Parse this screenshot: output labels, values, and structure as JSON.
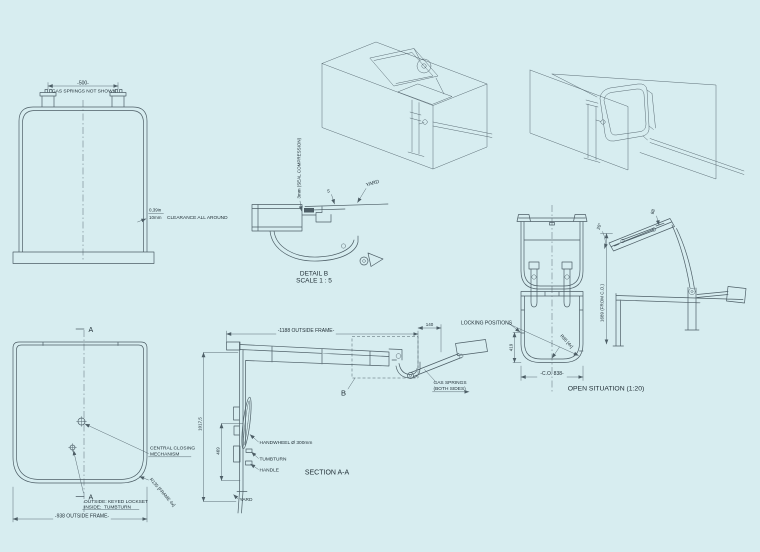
{
  "drawing": {
    "palette": {
      "background": "#d7edf0",
      "line": "#4d5e66",
      "text": "#233138"
    },
    "views": {
      "closed_view": {
        "dim_width": "-500-",
        "note": "GAS SPRINGS NOT SHOWN",
        "clearance_inches": "0,39in",
        "clearance_mm": "10mm",
        "clearance_note": "CLEARANCE ALL AROUND"
      },
      "detail_b": {
        "seal_note": "3mm (SEAL COMPRESSION)",
        "yard_label": "YARD",
        "dim_seal": "5",
        "title": "DETAIL B",
        "scale": "SCALE 1 : 5"
      },
      "open_front": {
        "locking_note": "LOCKING POSITIONS",
        "dim_height": "419",
        "radius_note": "R85 [4x]",
        "dim_clear_opening": "-C.O. 838-",
        "title": "OPEN SITUATION (1:20)"
      },
      "open_side": {
        "dim_angle": "20°",
        "dim_overlap": "88",
        "dim_height": "1689 (FROM C.O.)"
      },
      "front_view": {
        "section_mark_top": "A",
        "section_mark_bottom": "A",
        "central_note_line1": "CENTRAL CLOSING",
        "central_note_line2": "MECHANISM",
        "lockset_line1": "OUTSIDE: KEYED LOCKSET",
        "lockset_line2_label": "INSIDE:",
        "lockset_line2_value": "TUMBTURN",
        "radius_note": "R135 [FRAME 4x]",
        "dim_width": "-938 OUTSIDE FRAME-"
      },
      "section_aa": {
        "dim_width": "-1188 OUTSIDE FRAME-",
        "dim_hinge_offset": "140",
        "detail_callout": "B",
        "gas_note_line1": "GAS SPRINGS",
        "gas_note_line2": "(BOTH SIDES)",
        "handwheel_note": "HANDWHEEL Ø 300mm",
        "tumbturn_note": "TUMBTURN",
        "handle_note": "HANDLE",
        "yard_label": "YARD",
        "dim_height": "1017,5",
        "dim_handle_height": "469",
        "title": "SECTION A-A"
      }
    }
  }
}
